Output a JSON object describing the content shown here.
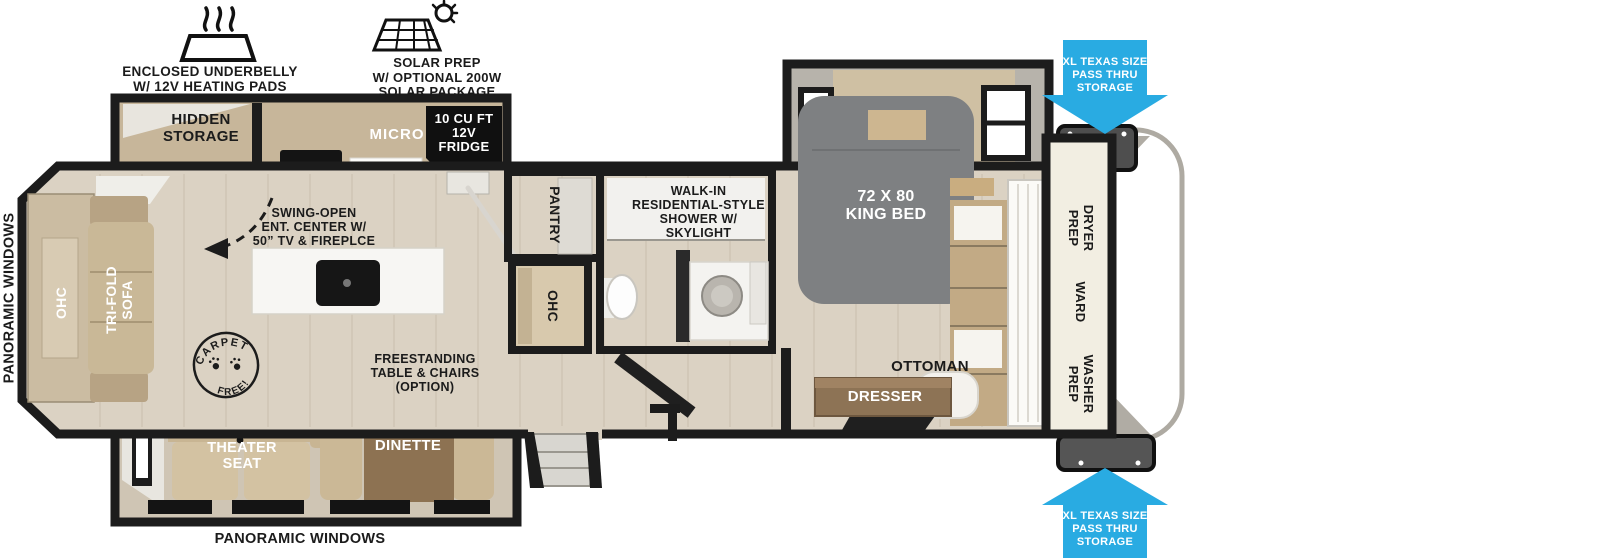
{
  "annotations": {
    "underbelly": "ENCLOSED UNDERBELLY\nW/ 12V HEATING PADS",
    "solar": "SOLAR PREP\nW/ OPTIONAL 200W\nSOLAR PACKAGE",
    "pass_thru_top": "XL TEXAS SIZE\nPASS THRU\nSTORAGE",
    "pass_thru_bottom": "XL TEXAS SIZE\nPASS THRU\nSTORAGE",
    "panoramic_left": "PANORAMIC WINDOWS",
    "panoramic_bottom": "PANORAMIC WINDOWS",
    "carpet_free_top": "CARPET",
    "carpet_free_bottom": "FREE!"
  },
  "living": {
    "hidden_storage": "HIDDEN\nSTORAGE",
    "micro": "MICRO",
    "fridge": "10 CU FT\n12V\nFRIDGE",
    "ent_center": "SWING-OPEN\nENT. CENTER W/\n50” TV & FIREPLCE",
    "ohc": "OHC",
    "sofa": "TRI-FOLD\nSOFA",
    "freestanding": "FREESTANDING\nTABLE & CHAIRS\n(OPTION)",
    "theater_seat": "THEATER\nSEAT",
    "dinette": "DINETTE"
  },
  "bath": {
    "pantry": "PANTRY",
    "ohc": "OHC",
    "shower": "WALK-IN\nRESIDENTIAL-STYLE\nSHOWER W/\nSKYLIGHT"
  },
  "bedroom": {
    "bed": "72 X 80\nKING BED",
    "ottoman": "OTTOMAN",
    "dresser": "DRESSER",
    "dryer_prep": "DRYER\nPREP",
    "ward": "WARD",
    "washer_prep": "WASHER\nPREP"
  },
  "colors": {
    "wall": "#1c1c1c",
    "floor": "#dbd2c3",
    "accent_blue": "#29abe2",
    "counter_tan": "#c7b69a",
    "bed_gray": "#7e8082"
  }
}
